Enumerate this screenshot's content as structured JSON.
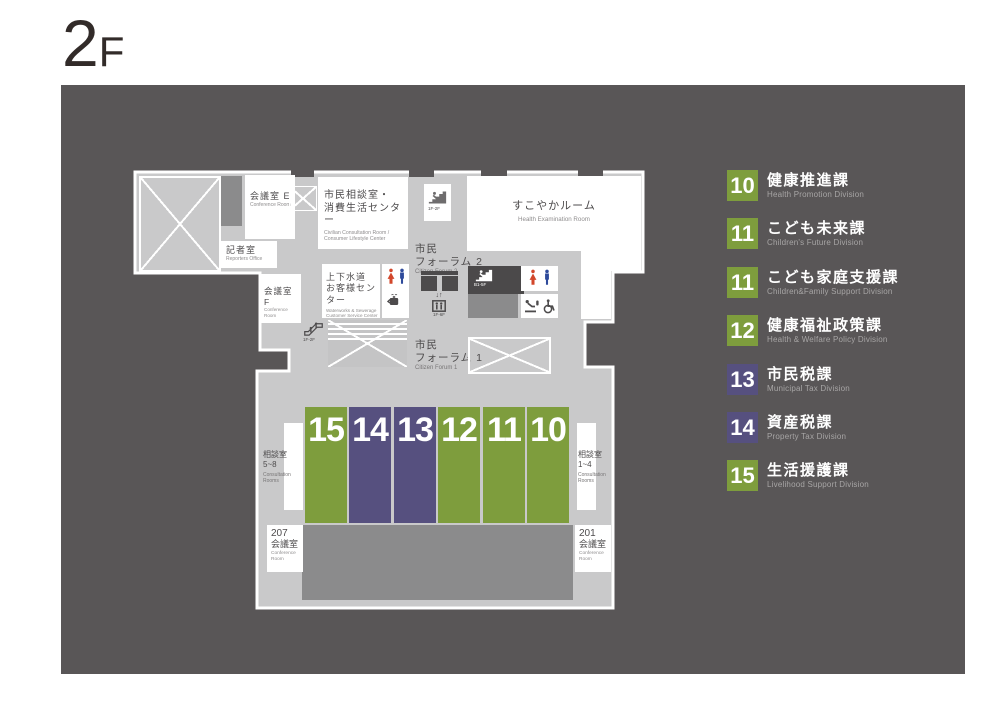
{
  "title": {
    "number": "2",
    "suffix": "F"
  },
  "legend": {
    "items": [
      {
        "num": "10",
        "ja": "健康推進課",
        "en": "Health Promotion Division",
        "color": "green"
      },
      {
        "num": "11",
        "ja": "こども未来課",
        "en": "Children's Future Division",
        "color": "green"
      },
      {
        "num": "11",
        "ja": "こども家庭支援課",
        "en": "Children&Family Support Division",
        "color": "green"
      },
      {
        "num": "12",
        "ja": "健康福祉政策課",
        "en": "Health & Welfare Policy Division",
        "color": "green"
      },
      {
        "num": "13",
        "ja": "市民税課",
        "en": "Municipal Tax Division",
        "color": "purple"
      },
      {
        "num": "14",
        "ja": "資産税課",
        "en": "Property Tax Division",
        "color": "purple"
      },
      {
        "num": "15",
        "ja": "生活援護課",
        "en": "Livelihood Support Division",
        "color": "green"
      }
    ]
  },
  "plan": {
    "rooms": {
      "conference_e": {
        "ja": "会議室 E",
        "en": "Conference Room"
      },
      "reporters": {
        "ja": "記者室",
        "en": "Reporters Office"
      },
      "conference_f": {
        "ja": "会議室 F",
        "en": "Conference Room"
      },
      "consultation_center": {
        "ja1": "市民相談室・",
        "ja2": "消費生活センター",
        "en1": "Civilian Consultation Room /",
        "en2": "Consumer Lifestyle Center"
      },
      "sukoyaka": {
        "ja": "すこやかルーム",
        "en": "Health Examination Room"
      },
      "waterworks": {
        "ja1": "上下水道",
        "ja2": "お客様センター",
        "en1": "Waterworks & Sewerage",
        "en2": "Customer Service Center"
      },
      "forum2": {
        "ja1": "市民",
        "ja2": "フォーラム 2",
        "en": "Citizen Forum 2"
      },
      "forum1": {
        "ja1": "市民",
        "ja2": "フォーラム 1",
        "en": "Citizen Forum 1"
      },
      "consult_5_8": {
        "ja1": "相談室",
        "ja2": "5~8",
        "en1": "Consultation",
        "en2": "Rooms"
      },
      "consult_1_4": {
        "ja1": "相談室",
        "ja2": "1~4",
        "en1": "Consultation",
        "en2": "Rooms"
      },
      "room_207": {
        "num": "207",
        "ja": "会議室",
        "en1": "Conference",
        "en2": "Room"
      },
      "room_201": {
        "num": "201",
        "ja": "会議室",
        "en1": "Conference",
        "en2": "Room"
      }
    },
    "facilities": {
      "stairs_top_label": "1F-2F",
      "stairs_b1_label": "B1-5F",
      "elevator_label": "1F-6F",
      "escalator_label": "1F-2F"
    },
    "blocks": [
      {
        "num": "15",
        "color": "green"
      },
      {
        "num": "14",
        "color": "purple"
      },
      {
        "num": "13",
        "color": "purple"
      },
      {
        "num": "12",
        "color": "green"
      },
      {
        "num": "11",
        "color": "green"
      },
      {
        "num": "10",
        "color": "green"
      }
    ]
  },
  "icons": {
    "stairs": "stairs-icon",
    "escalator": "escalator-icon",
    "elevator": "elevator-icon",
    "toilet_woman": "woman-icon",
    "toilet_man": "man-icon",
    "hot_water": "hot-water-icon",
    "baby_changing": "baby-changing-icon",
    "wheelchair": "wheelchair-icon"
  },
  "colors": {
    "background": "#595657",
    "floor": "#c9c9ca",
    "room_white": "#ffffff",
    "mid_gray": "#8b8b8c",
    "dark_gray": "#4d4b4c",
    "green": "#7e9d3d",
    "purple": "#56507f",
    "toilet_red": "#d2472b",
    "toilet_blue": "#2e4a9b"
  }
}
